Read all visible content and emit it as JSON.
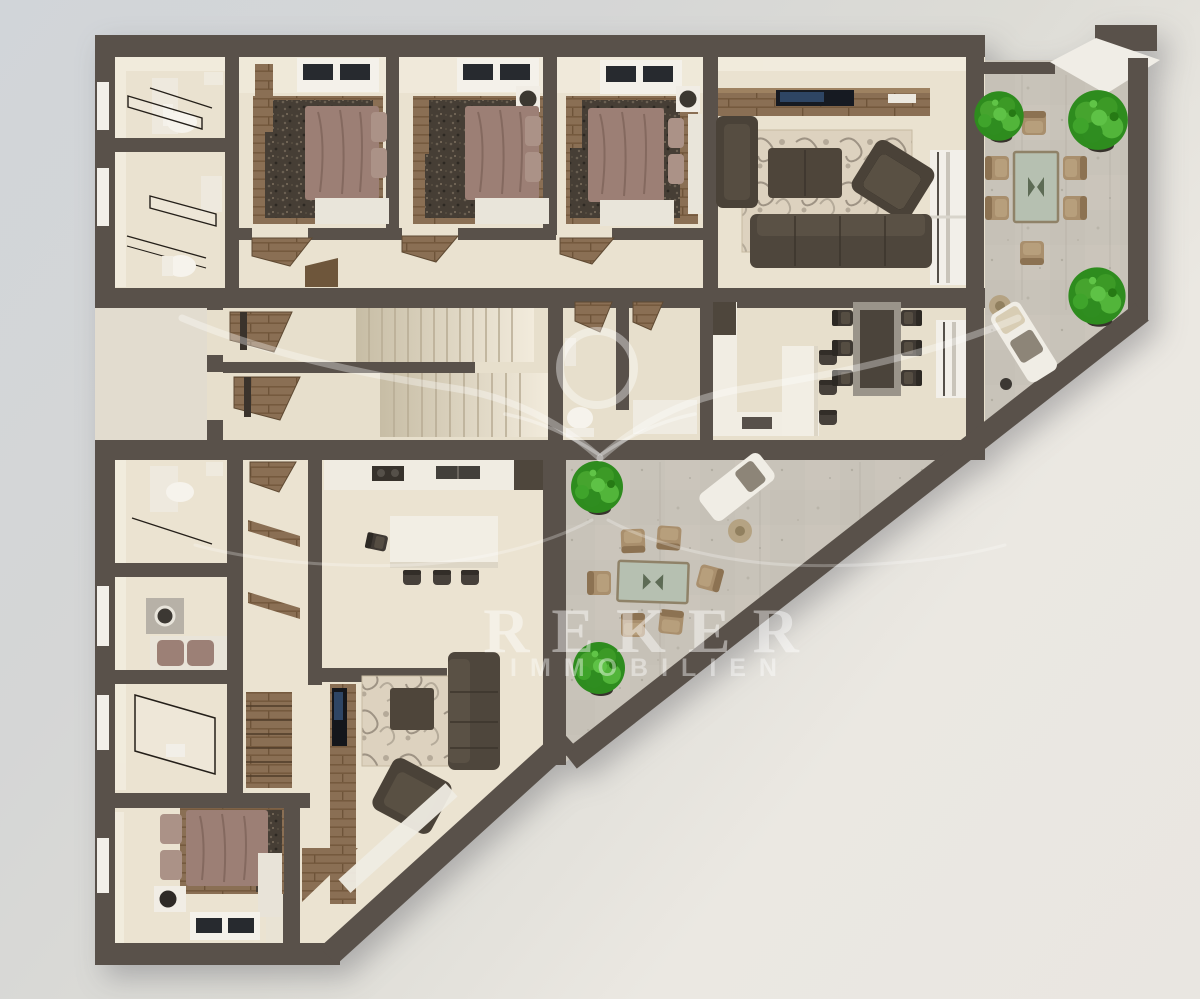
{
  "watermark": {
    "brand": "REKER",
    "subtitle": "IMMOBILIEN"
  },
  "palette": {
    "background_top_left": "#d1d5d9",
    "background_bottom_right": "#ebe8e2",
    "wall": "#59514a",
    "interior_floor": "#ebe3d1",
    "terrace_concrete": "#c8c3b9",
    "wood": "#8a6f54",
    "bed_mauve": "#9c7f75",
    "sofa_dark": "#4a4238",
    "rug_dark_mottled": "#463e35",
    "rug_damask": "#ddd2bf",
    "plant_green": "#3fa42b",
    "outdoor_chair_tan": "#a98f6d",
    "glass_table_top": "#b6c0b1",
    "white_fixture": "#f1eee8",
    "watermark_white": "rgba(255,255,255,0.42)"
  },
  "scene": {
    "type": "3d-floor-plan-top-view",
    "areas": [
      "bathroom",
      "shower-bathroom",
      "bedroom-1",
      "bedroom-2",
      "bedroom-3",
      "hallway",
      "living-room",
      "entrance-landing",
      "staircase",
      "wc",
      "entry",
      "kitchen-dining",
      "upper-terrace",
      "lower-wc",
      "laundry",
      "lower-shower-bathroom",
      "lower-hallway",
      "lower-kitchen",
      "lower-living-room",
      "lower-bedroom",
      "triangular-terrace"
    ],
    "plants": 5,
    "terrace_dining_chairs": 12
  }
}
